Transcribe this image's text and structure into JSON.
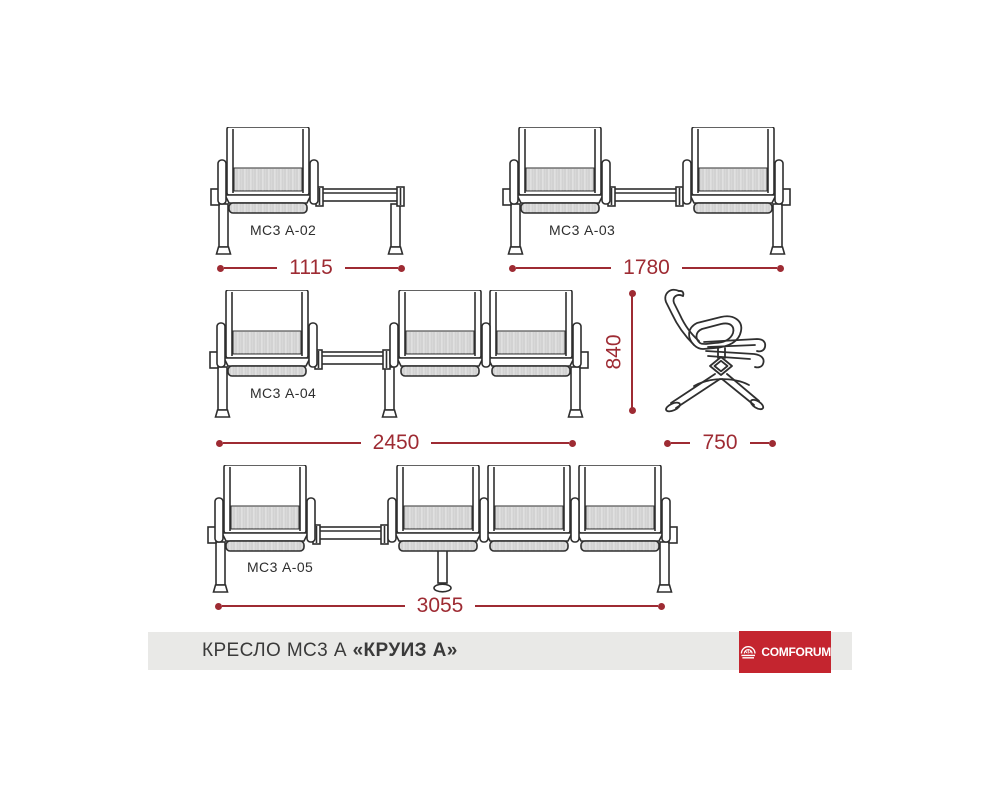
{
  "colors": {
    "line": "#2f2f2f",
    "dimension_red": "#9e2b33",
    "hatch_fill": "#e3e3e3",
    "hatch_stroke": "#b8b8b8",
    "footer_bg": "#e9e9e7",
    "logo_bg": "#c4252f",
    "logo_text": "#ffffff"
  },
  "configurations": [
    {
      "id": "mc3-a02",
      "label": "МС3 А-02",
      "dimension": "1115",
      "units": [
        "seat",
        "table"
      ]
    },
    {
      "id": "mc3-a03",
      "label": "МС3 А-03",
      "dimension": "1780",
      "units": [
        "seat",
        "table",
        "seat"
      ]
    },
    {
      "id": "mc3-a04",
      "label": "МС3 А-04",
      "dimension": "2450",
      "units": [
        "seat",
        "table",
        "seat",
        "seat"
      ]
    },
    {
      "id": "mc3-a05",
      "label": "МС3 А-05",
      "dimension": "3055",
      "units": [
        "seat",
        "table",
        "seat",
        "seat",
        "seat"
      ]
    }
  ],
  "side_view": {
    "height_dimension": "840",
    "depth_dimension": "750"
  },
  "footer": {
    "title_prefix": "КРЕСЛО МС3 А ",
    "title_emphasis": "«КРУИЗ А»",
    "brand": "COMFORUM"
  }
}
